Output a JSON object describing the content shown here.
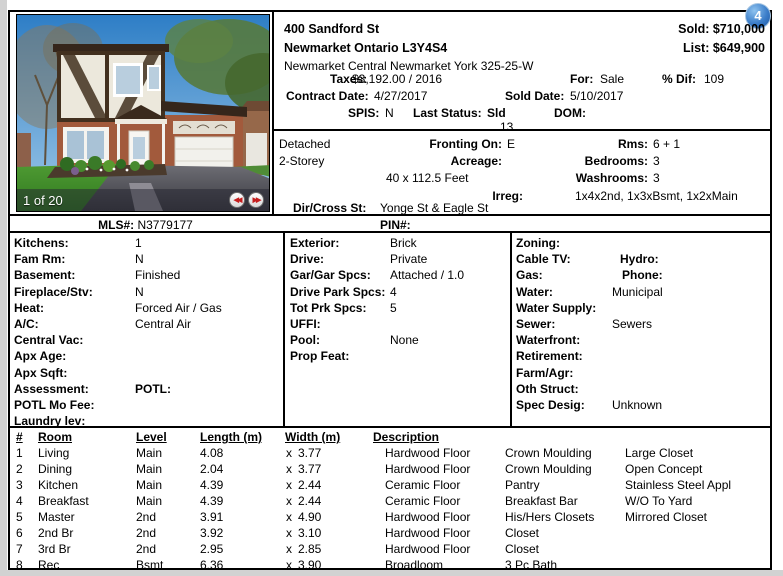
{
  "badge": {
    "count": "4"
  },
  "photo": {
    "counter": "1 of 20",
    "prev_icon": "◀◀",
    "next_icon": "▶▶"
  },
  "header": {
    "address": "400 Sandford St",
    "city_postal": "Newmarket Ontario L3Y4S4",
    "community": "Newmarket Central Newmarket York 325-25-W",
    "sold_label": "Sold:",
    "sold_value": "$710,000",
    "list_label": "List:",
    "list_value": "$649,900",
    "taxes_label": "Taxes:",
    "taxes_value": "$3,192.00 / 2016",
    "for_label": "For:",
    "for_value": "Sale",
    "pct_dif_label": "% Dif:",
    "pct_dif_value": "109",
    "contract_label": "Contract Date:",
    "contract_value": "4/27/2017",
    "sold_date_label": "Sold Date:",
    "sold_date_value": "5/10/2017",
    "spis_label": "SPIS:",
    "spis_value": "N",
    "last_status_label": "Last Status:",
    "last_status_value": "Sld",
    "dom_label": "DOM:",
    "dom_value": "13"
  },
  "summary": {
    "type": "Detached",
    "style": "2-Storey",
    "fronting_label": "Fronting On:",
    "fronting_value": "E",
    "acreage_label": "Acreage:",
    "acreage_value": "",
    "lot_size": "40 x 112.5 Feet",
    "irreg_label": "Irreg:",
    "irreg_value": "",
    "rms_label": "Rms:",
    "rms_value": "6 + 1",
    "bedrooms_label": "Bedrooms:",
    "bedrooms_value": "3",
    "washrooms_label": "Washrooms:",
    "washrooms_value": "3",
    "washrooms_detail": "1x4x2nd, 1x3xBsmt, 1x2xMain",
    "dir_cross_label": "Dir/Cross St:",
    "dir_cross_value": "Yonge St & Eagle St"
  },
  "ids": {
    "mls_label": "MLS#:",
    "mls_value": "N3779177",
    "pin_label": "PIN#:",
    "pin_value": ""
  },
  "details": {
    "left": [
      {
        "label": "Kitchens:",
        "value": "1"
      },
      {
        "label": "Fam Rm:",
        "value": "N"
      },
      {
        "label": "Basement:",
        "value": "Finished"
      },
      {
        "label": "Fireplace/Stv:",
        "value": "N"
      },
      {
        "label": "Heat:",
        "value": "Forced Air / Gas"
      },
      {
        "label": "A/C:",
        "value": "Central Air"
      },
      {
        "label": "Central Vac:",
        "value": ""
      },
      {
        "label": "Apx Age:",
        "value": ""
      },
      {
        "label": "Apx Sqft:",
        "value": ""
      },
      {
        "label": "Assessment:",
        "label2": "POTL:",
        "value": ""
      },
      {
        "label": "POTL Mo Fee:",
        "value": ""
      },
      {
        "label": "Laundry lev:",
        "value": ""
      }
    ],
    "middle": [
      {
        "label": "Exterior:",
        "value": "Brick"
      },
      {
        "label": "Drive:",
        "value": "Private"
      },
      {
        "label": "Gar/Gar Spcs:",
        "value": "Attached / 1.0"
      },
      {
        "label": "Drive Park Spcs:",
        "value": "4"
      },
      {
        "label": "Tot Prk Spcs:",
        "value": "5"
      },
      {
        "label": "UFFI:",
        "value": ""
      },
      {
        "label": "Pool:",
        "value": "None"
      },
      {
        "label": "Prop Feat:",
        "value": ""
      }
    ],
    "right": [
      {
        "label": "Zoning:",
        "value": ""
      },
      {
        "label": "Cable TV:",
        "label2": "Hydro:",
        "value": ""
      },
      {
        "label": "Gas:",
        "label2": "Phone:",
        "value": ""
      },
      {
        "label": "Water:",
        "value": "Municipal"
      },
      {
        "label": "Water Supply:",
        "value": ""
      },
      {
        "label": "Sewer:",
        "value": "Sewers"
      },
      {
        "label": "Waterfront:",
        "value": ""
      },
      {
        "label": "Retirement:",
        "value": ""
      },
      {
        "label": "Farm/Agr:",
        "value": ""
      },
      {
        "label": "Oth Struct:",
        "value": ""
      },
      {
        "label": "Spec Desig:",
        "value": "Unknown"
      }
    ]
  },
  "rooms": {
    "mult": "x",
    "headers": {
      "num": "#",
      "room": "Room",
      "level": "Level",
      "length": "Length (m)",
      "width": "Width (m)",
      "description": "Description"
    },
    "rows": [
      {
        "num": "1",
        "room": "Living",
        "level": "Main",
        "length": "4.08",
        "width": "3.77",
        "desc1": "Hardwood Floor",
        "desc2": "Crown Moulding",
        "desc3": "Large Closet"
      },
      {
        "num": "2",
        "room": "Dining",
        "level": "Main",
        "length": "2.04",
        "width": "3.77",
        "desc1": "Hardwood Floor",
        "desc2": "Crown Moulding",
        "desc3": "Open Concept"
      },
      {
        "num": "3",
        "room": "Kitchen",
        "level": "Main",
        "length": "4.39",
        "width": "2.44",
        "desc1": "Ceramic Floor",
        "desc2": "Pantry",
        "desc3": "Stainless Steel Appl"
      },
      {
        "num": "4",
        "room": "Breakfast",
        "level": "Main",
        "length": "4.39",
        "width": "2.44",
        "desc1": "Ceramic Floor",
        "desc2": "Breakfast Bar",
        "desc3": "W/O To Yard"
      },
      {
        "num": "5",
        "room": "Master",
        "level": "2nd",
        "length": "3.91",
        "width": "4.90",
        "desc1": "Hardwood Floor",
        "desc2": "His/Hers Closets",
        "desc3": "Mirrored Closet"
      },
      {
        "num": "6",
        "room": "2nd Br",
        "level": "2nd",
        "length": "3.92",
        "width": "3.10",
        "desc1": "Hardwood Floor",
        "desc2": "Closet",
        "desc3": ""
      },
      {
        "num": "7",
        "room": "3rd Br",
        "level": "2nd",
        "length": "2.95",
        "width": "2.85",
        "desc1": "Hardwood Floor",
        "desc2": "Closet",
        "desc3": ""
      },
      {
        "num": "8",
        "room": "Rec",
        "level": "Bsmt",
        "length": "6.36",
        "width": "3.90",
        "desc1": "Broadloom",
        "desc2": "3 Pc Bath",
        "desc3": ""
      }
    ]
  }
}
